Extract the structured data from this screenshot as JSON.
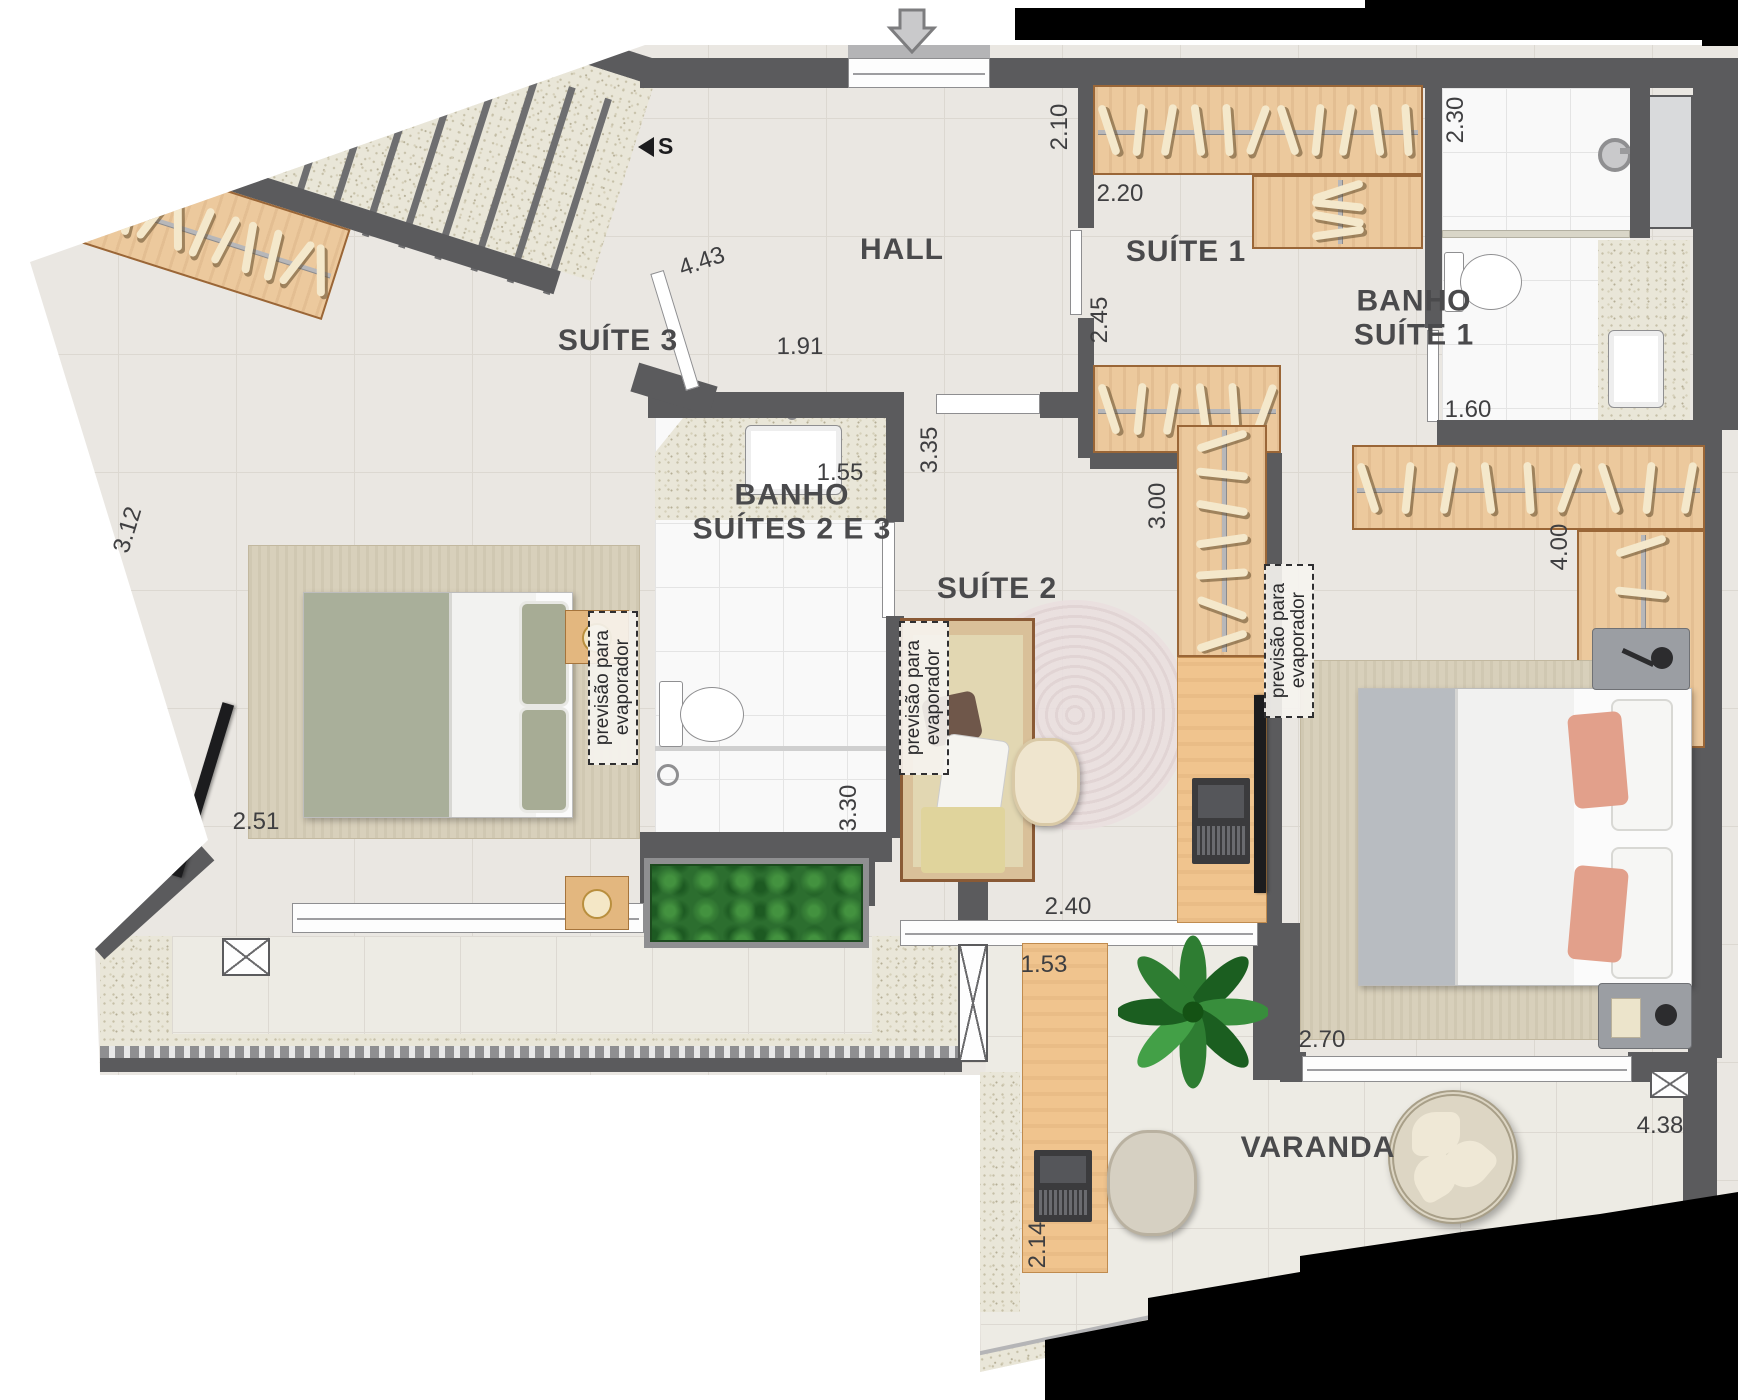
{
  "title": "Planta - pavimento superior (suítes)",
  "plan": {
    "entry": {
      "arrow_icon": "down-arrow",
      "stairs_direction_label": "S"
    },
    "rooms": [
      {
        "id": "hall",
        "lines": [
          "HALL"
        ],
        "x": 902,
        "y": 250
      },
      {
        "id": "suite-1",
        "lines": [
          "SUÍTE 1"
        ],
        "x": 1186,
        "y": 252
      },
      {
        "id": "banho-suite-1",
        "lines": [
          "BANHO",
          "SUÍTE 1"
        ],
        "x": 1414,
        "y": 318
      },
      {
        "id": "suite-3",
        "lines": [
          "SUÍTE 3"
        ],
        "x": 618,
        "y": 341
      },
      {
        "id": "banho-suites-2-3",
        "lines": [
          "BANHO",
          "SUÍTES 2 E 3"
        ],
        "x": 792,
        "y": 512
      },
      {
        "id": "suite-2",
        "lines": [
          "SUÍTE 2"
        ],
        "x": 997,
        "y": 589
      },
      {
        "id": "varanda",
        "lines": [
          "VARANDA"
        ],
        "x": 1318,
        "y": 1148
      }
    ],
    "dimensions": [
      {
        "v": "2.10",
        "x": 1060,
        "y": 127,
        "rot": -90
      },
      {
        "v": "2.20",
        "x": 1120,
        "y": 194,
        "rot": 0
      },
      {
        "v": "2.45",
        "x": 1100,
        "y": 320,
        "rot": -90
      },
      {
        "v": "2.30",
        "x": 1456,
        "y": 120,
        "rot": -90
      },
      {
        "v": "1.60",
        "x": 1468,
        "y": 410,
        "rot": 0
      },
      {
        "v": "4.43",
        "x": 702,
        "y": 262,
        "rot": -19
      },
      {
        "v": "1.91",
        "x": 800,
        "y": 347,
        "rot": 0
      },
      {
        "v": "3.35",
        "x": 930,
        "y": 450,
        "rot": -90
      },
      {
        "v": "1.55",
        "x": 840,
        "y": 473,
        "rot": 0
      },
      {
        "v": "3.00",
        "x": 1158,
        "y": 506,
        "rot": -90
      },
      {
        "v": "4.00",
        "x": 1560,
        "y": 547,
        "rot": -90
      },
      {
        "v": "3.12",
        "x": 128,
        "y": 530,
        "rot": -73
      },
      {
        "v": "2.51",
        "x": 256,
        "y": 822,
        "rot": 0
      },
      {
        "v": "3.30",
        "x": 849,
        "y": 808,
        "rot": -90
      },
      {
        "v": "2.40",
        "x": 1068,
        "y": 907,
        "rot": 0
      },
      {
        "v": "1.53",
        "x": 1044,
        "y": 965,
        "rot": 0
      },
      {
        "v": "2.70",
        "x": 1322,
        "y": 1040,
        "rot": 0
      },
      {
        "v": "2.14",
        "x": 1038,
        "y": 1245,
        "rot": -90
      },
      {
        "v": "4.38",
        "x": 1660,
        "y": 1126,
        "rot": 0
      }
    ],
    "notes": [
      {
        "lines": [
          "previsão para",
          "evaporador"
        ],
        "x": 613,
        "y": 688
      },
      {
        "lines": [
          "previsão para",
          "evaporador"
        ],
        "x": 924,
        "y": 698
      },
      {
        "lines": [
          "previsão para",
          "evaporador"
        ],
        "x": 1289,
        "y": 641
      }
    ],
    "colors": {
      "wall": "#5b5b5d",
      "floor": "#eae7e2",
      "bath_floor": "#f9f9f9",
      "wood": "#ecc99d",
      "granite": "#e9e6d8",
      "bed_green": "#a9af9a",
      "bed_gray": "#b8bcc1",
      "pillow_salmon": "#e2a08b",
      "bed_tan": "#e2d7b2",
      "plant_green": "#2e7d32",
      "mask": "#000000"
    }
  }
}
